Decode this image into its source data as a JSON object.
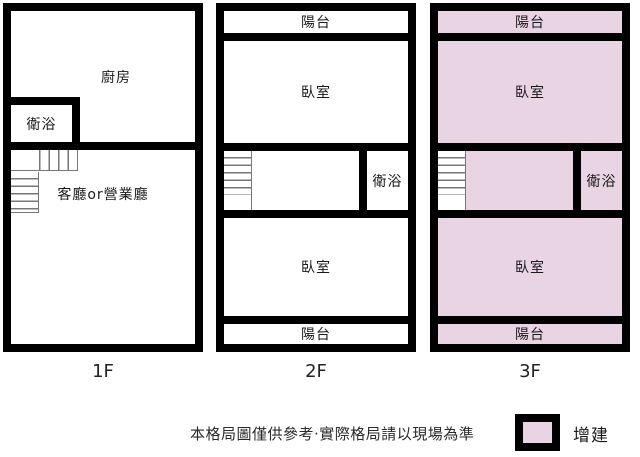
{
  "colors": {
    "wall": "#000000",
    "addition": "#e8d4e2",
    "stair_line": "#777777",
    "text": "#1a1a1a"
  },
  "floors": [
    {
      "label": "1F",
      "highlighted": false,
      "rooms": {
        "kitchen": "廚房",
        "bath": "衛浴",
        "living": "客廳or營業廳"
      }
    },
    {
      "label": "2F",
      "highlighted": false,
      "rooms": {
        "balcony_top": "陽台",
        "bedroom_top": "臥室",
        "bath": "衛浴",
        "bedroom_bottom": "臥室",
        "balcony_bottom": "陽台"
      }
    },
    {
      "label": "3F",
      "highlighted": true,
      "rooms": {
        "balcony_top": "陽台",
        "bedroom_top": "臥室",
        "bath": "衛浴",
        "bedroom_bottom": "臥室",
        "balcony_bottom": "陽台"
      }
    }
  ],
  "footer": {
    "disclaimer": "本格局圖僅供參考·實際格局請以現場為準",
    "legend_label": "增建"
  }
}
